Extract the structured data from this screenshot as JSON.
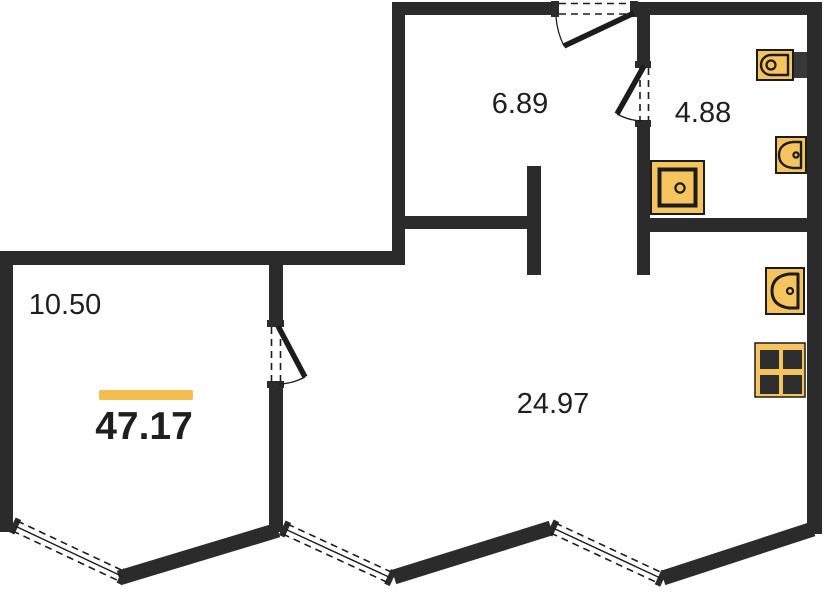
{
  "plan": {
    "total_area": "47.17",
    "rooms": [
      {
        "id": "hallway",
        "area": "6.89"
      },
      {
        "id": "bathroom",
        "area": "4.88"
      },
      {
        "id": "room-left",
        "area": "10.50"
      },
      {
        "id": "living-kitchen",
        "area": "24.97"
      }
    ],
    "fixtures": [
      "toilet-icon",
      "washbasin-icon",
      "shower-icon",
      "kitchen-sink-icon",
      "stove-icon"
    ],
    "openings": [
      "entrance-door-icon",
      "bathroom-door-icon",
      "room-door-icon",
      "window-icon",
      "window-icon",
      "window-icon"
    ]
  },
  "colors": {
    "wall": "#2b2b2b",
    "outline": "#1c1c1c",
    "fixture_fill": "#f6c45f",
    "accent_bar": "#f2be4e",
    "background": "#ffffff",
    "text": "#1f1f1f"
  }
}
